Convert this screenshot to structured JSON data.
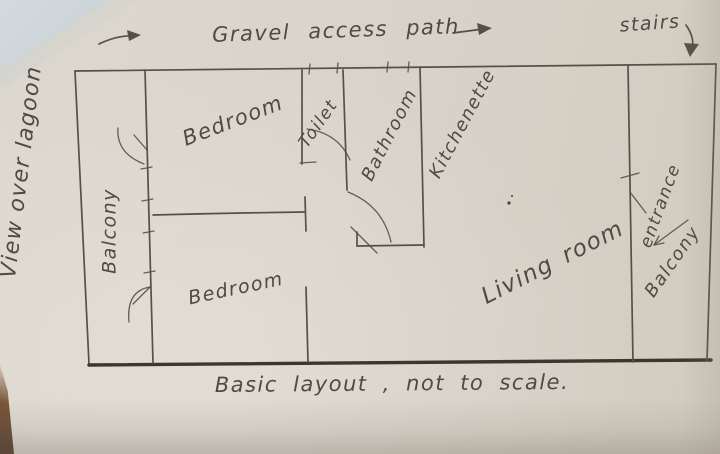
{
  "annotations": {
    "gravel_path": "Gravel access path",
    "stairs": "stairs",
    "view": "View over lagoon",
    "caption": "Basic layout , not to scale."
  },
  "rooms": {
    "balcony_left": "Balcony",
    "bedroom_top": "Bedroom",
    "bedroom_bottom": "Bedroom",
    "toilet": "Toilet",
    "bathroom": "Bathroom",
    "kitchenette": "Kitchenette",
    "living_room": "Living room",
    "entrance": "entrance",
    "balcony_right": "Balcony"
  },
  "colors": {
    "paper": "#d9d4ca",
    "pencil": "#55504a",
    "ink": "#4f4a43",
    "heavy_line": "#3b372f"
  }
}
